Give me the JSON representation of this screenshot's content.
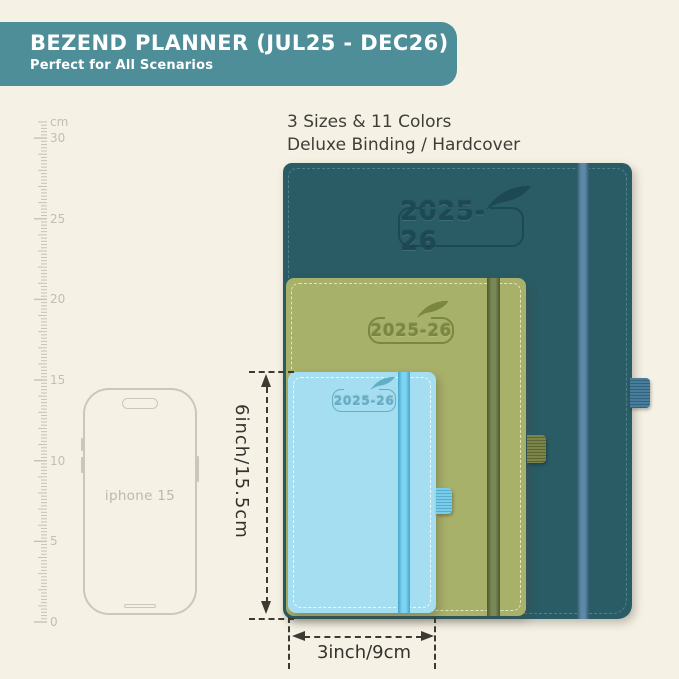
{
  "background_color": "#f5f1e5",
  "banner": {
    "title": "BEZEND PLANNER (JUL25 - DEC26)",
    "subtitle": "Perfect for All Scenarios",
    "bg_color": "#4e8e99",
    "text_color": "#ffffff"
  },
  "info": {
    "line1": "3 Sizes & 11 Colors",
    "line2": "Deluxe Binding / Hardcover"
  },
  "ruler": {
    "unit_label": "cm",
    "max_cm": 31,
    "px_per_cm": 16.13,
    "tick_color": "#c6c2b5",
    "label_color": "#c2beb0",
    "labels": [
      {
        "text": "cm",
        "cm": 31
      },
      {
        "text": "30",
        "cm": 30
      },
      {
        "text": "25",
        "cm": 25
      },
      {
        "text": "20",
        "cm": 20
      },
      {
        "text": "15",
        "cm": 15
      },
      {
        "text": "10",
        "cm": 10
      },
      {
        "text": "5",
        "cm": 5
      },
      {
        "text": "0",
        "cm": 0
      }
    ]
  },
  "phone": {
    "label": "iphone 15",
    "outline_color": "#cbc7bb"
  },
  "planners": [
    {
      "id": "large-teal",
      "year_label": "2025-26",
      "cover_color": "#2a5c66",
      "band_color": "#4a7d9c",
      "emboss_color": "#1c4954"
    },
    {
      "id": "medium-green",
      "year_label": "2025-26",
      "cover_color": "#a8b16a",
      "band_color": "#68773f",
      "emboss_color": "#79873f"
    },
    {
      "id": "small-blue",
      "year_label": "2025-26",
      "cover_color": "#a5def0",
      "band_color": "#52c4ee",
      "emboss_color": "#63aec7"
    }
  ],
  "dimensions": {
    "height_label": "6inch/15.5cm",
    "width_label": "3inch/9cm",
    "line_color": "#3b3b34"
  }
}
